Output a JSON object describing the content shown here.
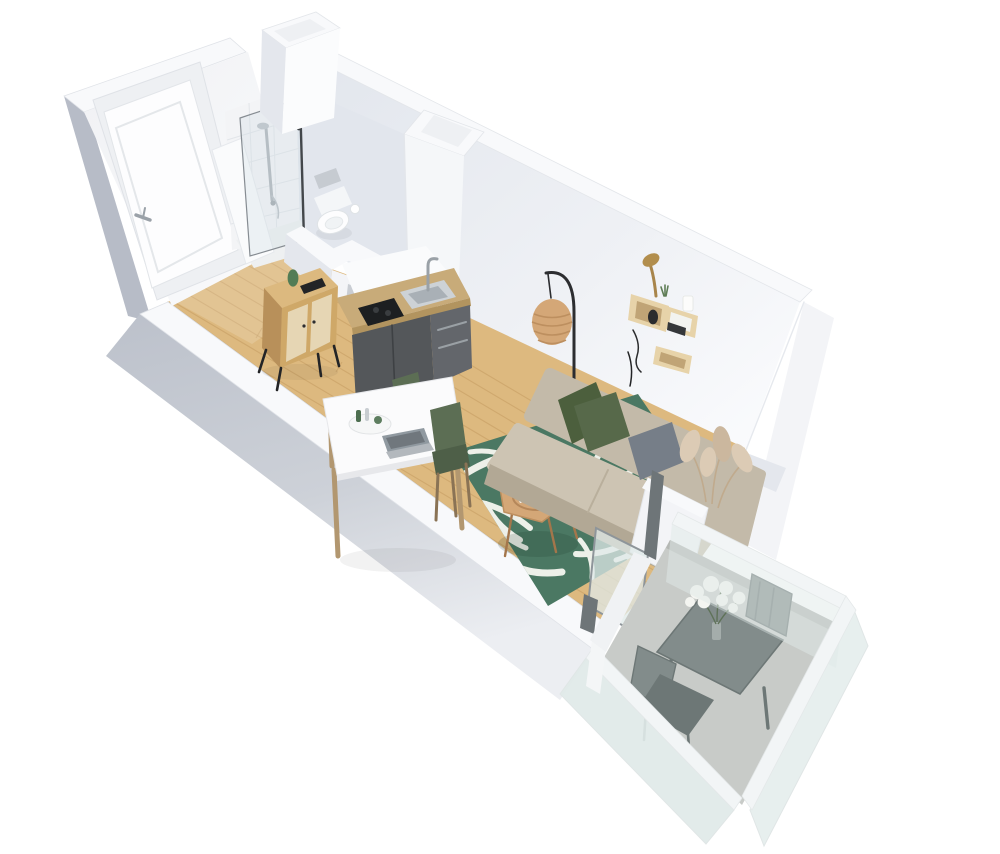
{
  "scene": {
    "label": "3D floor plan render of a studio apartment with entrance, bathroom, kitchenette, dining area, living area and balcony",
    "objects": [
      "entrance-door",
      "shower",
      "toilet",
      "half-wall",
      "wooden-sideboard",
      "kitchenette",
      "dining-table",
      "laptop",
      "dining-chairs",
      "wood-floor",
      "palm-leaf-rug",
      "sofa",
      "cushions",
      "pampas-grass",
      "rattan-floor-lamp",
      "wall-shelves",
      "desk-lamp",
      "coffee-table",
      "balcony",
      "balcony-table",
      "balcony-chairs",
      "flower-vase",
      "frosted-glass-railing"
    ],
    "palette": {
      "bg": "#ffffff",
      "wall_top": "#f8f9fb",
      "wall_edge": "#dcdfe5",
      "wall_face": "#f3f4f7",
      "wall_face_dark": "#e4e7ed",
      "wall_ext": "#b7bcc7",
      "wall_ext_light": "#dfe1e7",
      "ne_wall_dark": "#e2e6ed",
      "ne_wall_light": "#f9fafc",
      "floor_wood": "#ddb97f",
      "floor_plank_line": "#c1985e",
      "rug_green": "#4b7863",
      "rug_leaf": "#edf0e9",
      "tile_line": "#e2e5e9",
      "glass_shower": "#cfdde2",
      "toilet_white": "#fdfdfe",
      "kitchen_dark": "#54575a",
      "kitchen_dark2": "#63666b",
      "counter_wood": "#c8ab79",
      "counter_edge": "#b2945f",
      "cooktop_black": "#1d1f21",
      "steel": "#cdd2d6",
      "steel_dark": "#a9b0b6",
      "sideboard_top": "#dcb97f",
      "sideboard_front": "#cfa868",
      "sideboard_side": "#b8905a",
      "sideboard_door": "#e6d6b4",
      "table_white": "#fbfbfc",
      "table_edge": "#e7e8eb",
      "wood_leg": "#b29770",
      "chair_green": "#5c6e54",
      "chair_green_dark": "#4e5f48",
      "laptop_gray": "#9099a0",
      "laptop_dark": "#70777d",
      "sofa_base": "#c3baa9",
      "sofa_seat": "#cdc4b3",
      "sofa_shadow": "#b2a895",
      "pillow_green": "#4c5f3d",
      "pillow_green2": "#57694a",
      "pillow_gray": "#767e88",
      "pampas": "#dccbb5",
      "pampas_dark": "#cbb79e",
      "lamp_black": "#2c2d30",
      "rattan": "#d4a777",
      "rattan_dark": "#bd8f5f",
      "shelf_wood": "#e7d3a9",
      "shelf_inner": "#c0a476",
      "brass": "#b28e4d",
      "balcony_floor": "#c8cbc8",
      "balcony_glass": "#dfe9e8",
      "balcony_rail": "#f2f5f6",
      "balcony_metal": "#828c8b",
      "balcony_metal_dark": "#6d7776",
      "flower_white": "#f4f5f1",
      "stem_green": "#5f7259",
      "frame_gray": "#8e959a",
      "black_accent": "#232426"
    }
  }
}
